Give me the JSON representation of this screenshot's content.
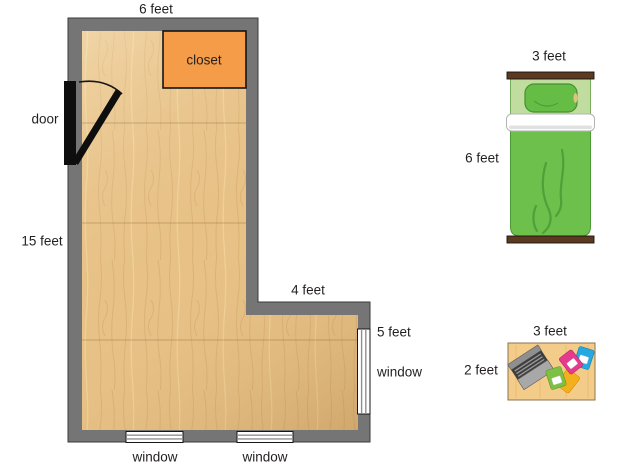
{
  "room": {
    "labels": {
      "top_width": "6 feet",
      "left_height": "15 feet",
      "door": "door",
      "closet": "closet",
      "notch_width": "4 feet",
      "right_wall": "5 feet",
      "window_right": "window",
      "window_bottom_left": "window",
      "window_bottom_right": "window"
    }
  },
  "bed": {
    "width": "3 feet",
    "length": "6 feet"
  },
  "desk": {
    "width": "3 feet",
    "depth": "2 feet"
  },
  "colors": {
    "wall": "#757575",
    "wall_outline": "#3a3a3a",
    "floor": "#e7c186",
    "floor_grain": "#d0a265",
    "closet": "#f49c47",
    "door": "#0e0e0e",
    "window_line": "#8f8f8f",
    "bed_green": "#6cc04b",
    "bed_green_dark": "#4c9a35",
    "bed_light_green": "#c0dc9e",
    "bed_frame_brown": "#5d3a1e",
    "sheet_white": "#ffffff",
    "desk_top": "#f4cc8a",
    "desk_border": "#8d7350",
    "laptop_gray": "#a8a8a8",
    "laptop_dark": "#3e3e3e",
    "notebook_green": "#7ec044",
    "notebook_yellow": "#f3b01c",
    "notebook_blue": "#27a8e0",
    "notebook_pink": "#e63a8e",
    "text": "#231f20"
  }
}
